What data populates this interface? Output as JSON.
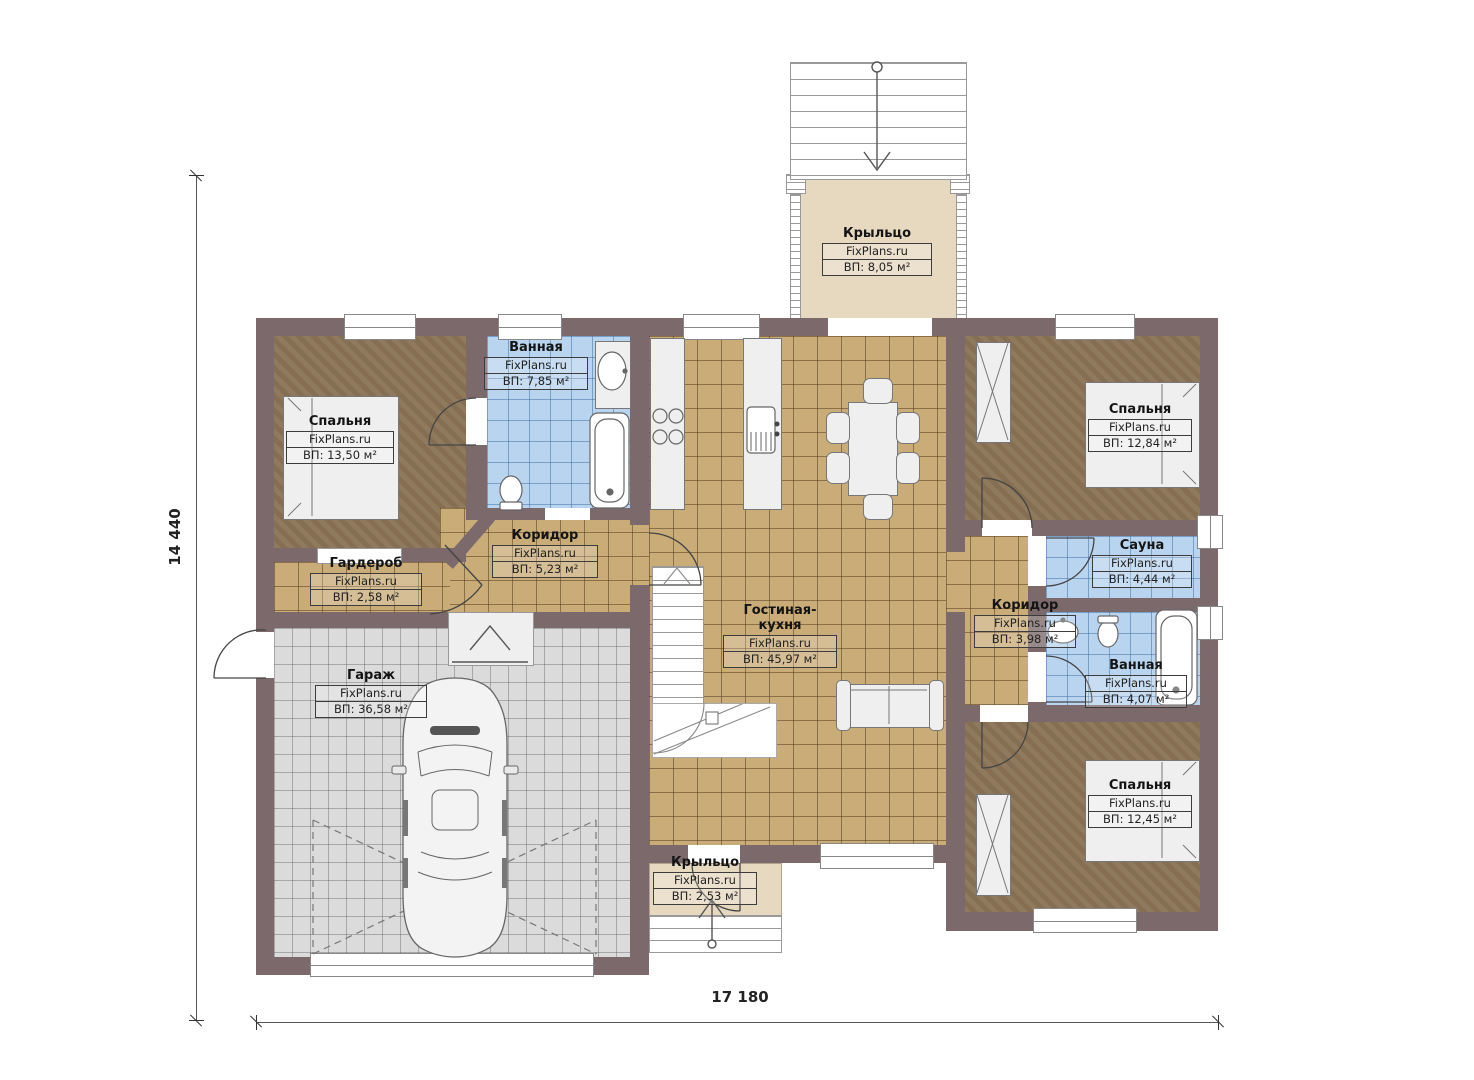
{
  "plan": {
    "dimension_width": "17 180",
    "dimension_height": "14 440"
  },
  "rooms": [
    {
      "id": "porch-top",
      "name": "Крыльцо",
      "site": "FixPlans.ru",
      "area": "ВП: 8,05 м²"
    },
    {
      "id": "bedroom-left",
      "name": "Спальня",
      "site": "FixPlans.ru",
      "area": "ВП: 13,50 м²"
    },
    {
      "id": "bathroom-left",
      "name": "Ванная",
      "site": "FixPlans.ru",
      "area": "ВП: 7,85 м²"
    },
    {
      "id": "corridor-left",
      "name": "Коридор",
      "site": "FixPlans.ru",
      "area": "ВП: 5,23 м²"
    },
    {
      "id": "wardrobe",
      "name": "Гардероб",
      "site": "FixPlans.ru",
      "area": "ВП: 2,58 м²"
    },
    {
      "id": "garage",
      "name": "Гараж",
      "site": "FixPlans.ru",
      "area": "ВП: 36,58 м²"
    },
    {
      "id": "living-kitchen",
      "name": "Гостиная-кухня",
      "site": "FixPlans.ru",
      "area": "ВП: 45,97 м²"
    },
    {
      "id": "bedroom-top-right",
      "name": "Спальня",
      "site": "FixPlans.ru",
      "area": "ВП: 12,84 м²"
    },
    {
      "id": "sauna",
      "name": "Сауна",
      "site": "FixPlans.ru",
      "area": "ВП: 4,44 м²"
    },
    {
      "id": "corridor-right",
      "name": "Коридор",
      "site": "FixPlans.ru",
      "area": "ВП: 3,98 м²"
    },
    {
      "id": "bathroom-right",
      "name": "Ванная",
      "site": "FixPlans.ru",
      "area": "ВП: 4,07 м²"
    },
    {
      "id": "bedroom-bottom-right",
      "name": "Спальня",
      "site": "FixPlans.ru",
      "area": "ВП: 12,45 м²"
    },
    {
      "id": "porch-bottom",
      "name": "Крыльцо",
      "site": "FixPlans.ru",
      "area": "ВП: 2,53 м²"
    }
  ],
  "colors": {
    "wall": "#7b696b",
    "bedroom_floor": "#8a7355",
    "bath_floor": "#b9d4ee",
    "tile_floor": "#c9ac78",
    "garage_floor": "#dbdbdb",
    "porch_floor": "#e7d8c0"
  }
}
